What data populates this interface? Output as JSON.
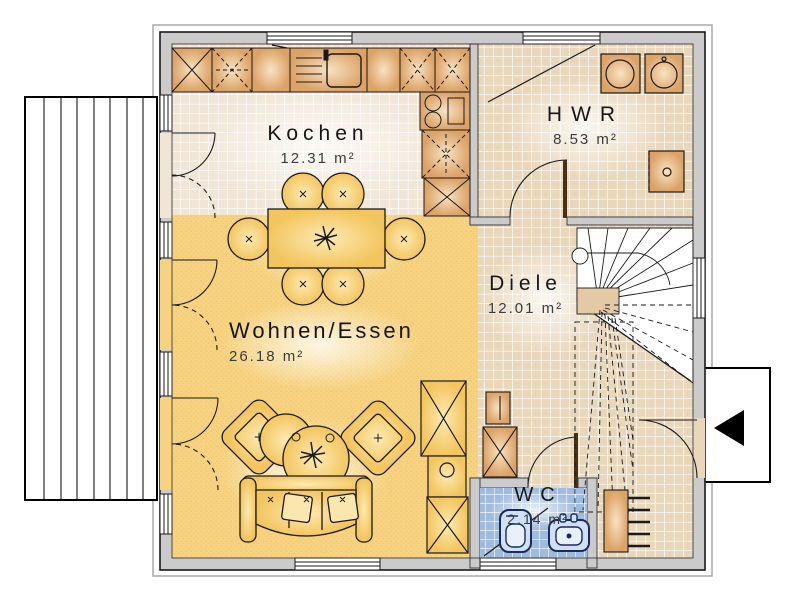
{
  "rooms": {
    "kochen": {
      "name": "Kochen",
      "area": "12.31 m²"
    },
    "hwr": {
      "name": "HWR",
      "area": "8.53 m²"
    },
    "diele": {
      "name": "Diele",
      "area": "12.01 m²"
    },
    "wohnen": {
      "name": "Wohnen/Essen",
      "area": "26.18 m²"
    },
    "wc": {
      "name": "WC",
      "area": "2.14 m²"
    }
  },
  "colors": {
    "wall": "#cbcbcb",
    "outline": "#1a1a1a",
    "kitchen_tile": "#f0e5d6",
    "hall_tile": "#e9d7bc",
    "wc_tile": "#9fbbde",
    "living_floor": "#f7d381",
    "cabinet_dark": "#dca266",
    "cabinet_light": "#f7e3c3",
    "furniture_dark": "#f3c55f",
    "furniture_light": "#fdeab2",
    "fixture_blue": "#cfe0f2",
    "fixture_stroke": "#1a2a5e",
    "entrance_arrow": "#000000"
  }
}
